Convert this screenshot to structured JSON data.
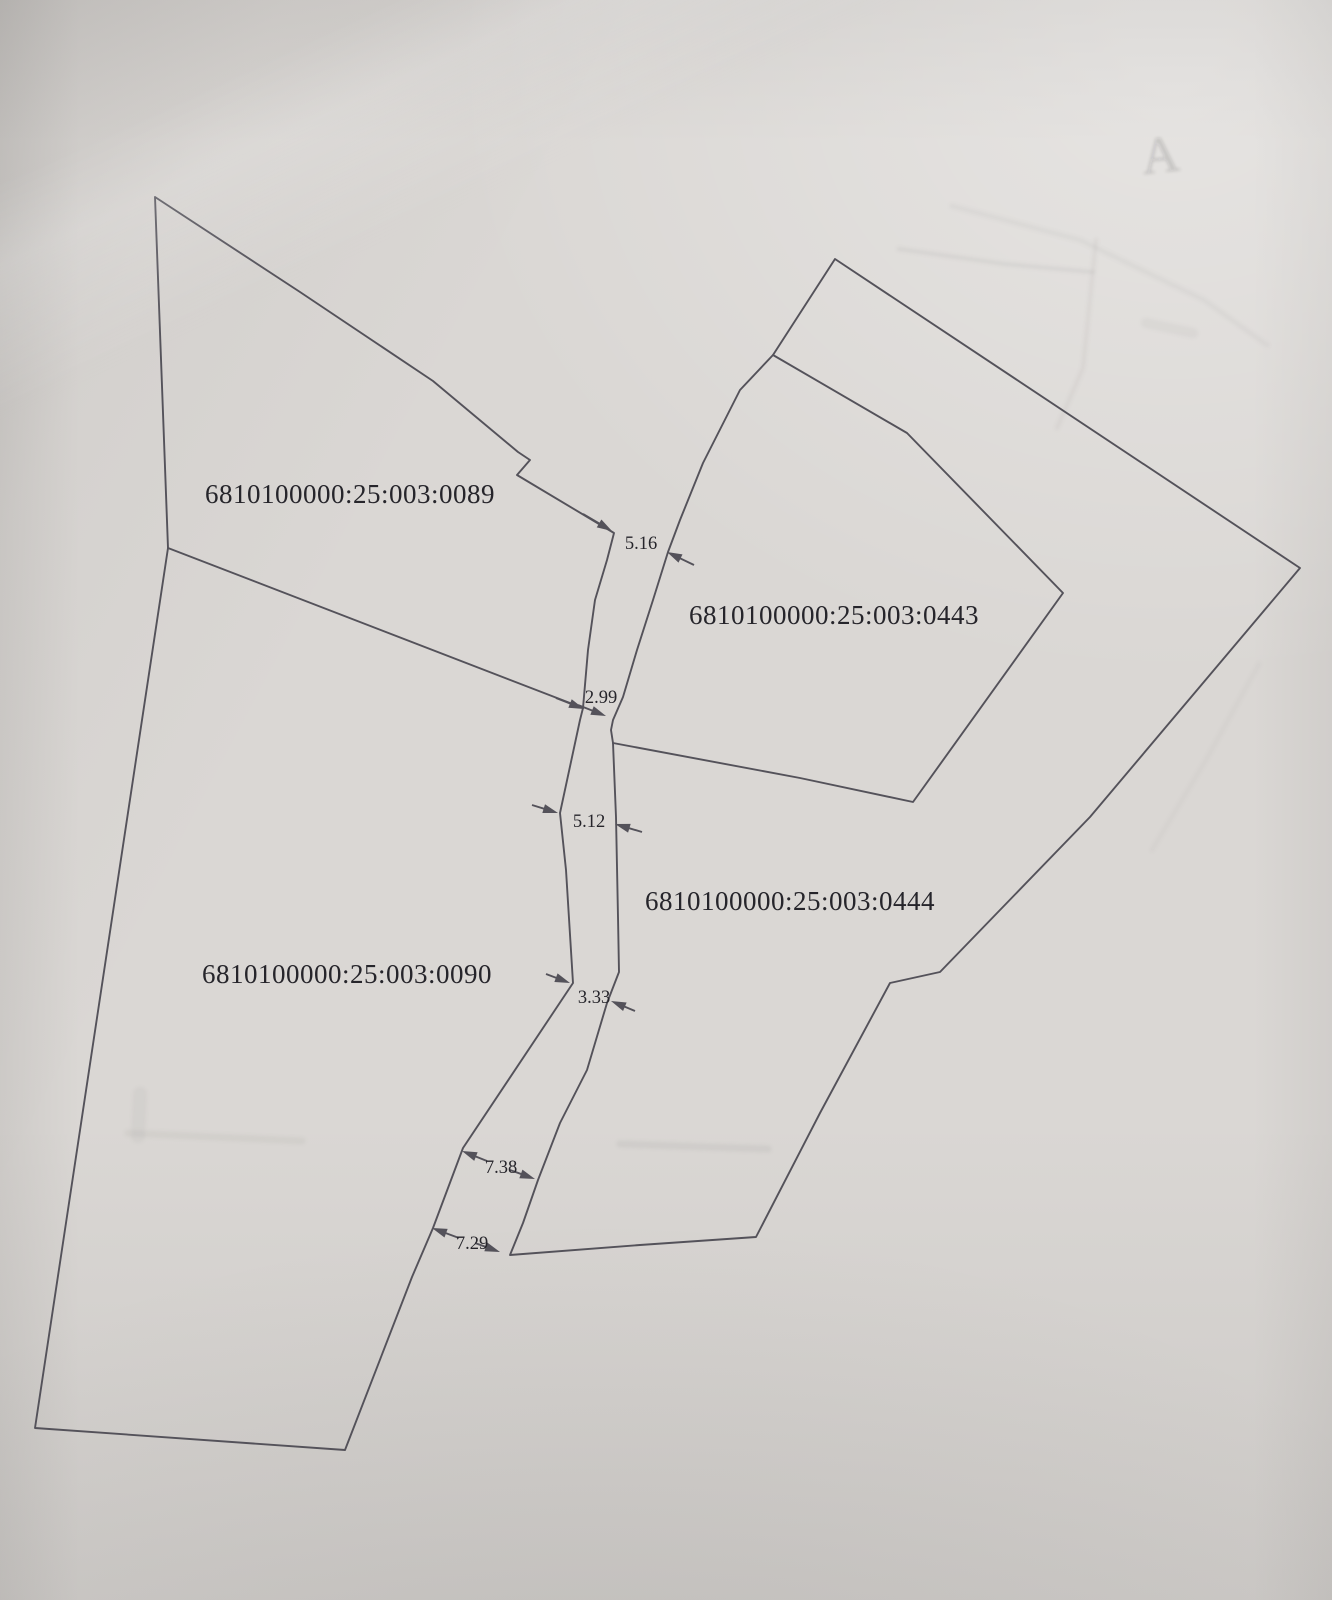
{
  "photo": {
    "description_colors": {
      "paper": "#dad7d4",
      "boundary_line": "#54525a",
      "text": "#26252b",
      "ghost": "#98958f"
    }
  },
  "map": {
    "width": 1332,
    "height": 1600,
    "line_color": "#54525a",
    "line_width": 1.9,
    "label_color": "#23222a",
    "label_font_size": 27,
    "dim_font_size": 18.5,
    "boundaries": [
      {
        "name": "left-block-outline",
        "closed": true,
        "points": [
          [
            155,
            197
          ],
          [
            300,
            292
          ],
          [
            433,
            381
          ],
          [
            518,
            452
          ],
          [
            530,
            460
          ],
          [
            517,
            475
          ],
          [
            614,
            533
          ],
          [
            607,
            560
          ],
          [
            595,
            600
          ],
          [
            588,
            650
          ],
          [
            583,
            708
          ],
          [
            580,
            720
          ],
          [
            560,
            813
          ],
          [
            566,
            870
          ],
          [
            573,
            983
          ],
          [
            463,
            1148
          ],
          [
            433,
            1228
          ],
          [
            412,
            1277
          ],
          [
            345,
            1450
          ],
          [
            35,
            1428
          ],
          [
            168,
            548
          ]
        ]
      },
      {
        "name": "boundary-0089-0090",
        "closed": false,
        "points": [
          [
            168,
            548
          ],
          [
            583,
            708
          ]
        ]
      },
      {
        "name": "right-block-outline",
        "closed": true,
        "points": [
          [
            835,
            259
          ],
          [
            1300,
            568
          ],
          [
            1090,
            817
          ],
          [
            940,
            972
          ],
          [
            890,
            983
          ],
          [
            820,
            1113
          ],
          [
            756,
            1237
          ],
          [
            640,
            1245
          ],
          [
            510,
            1255
          ],
          [
            523,
            1223
          ],
          [
            538,
            1180
          ],
          [
            560,
            1123
          ],
          [
            587,
            1070
          ],
          [
            607,
            1003
          ],
          [
            619,
            972
          ],
          [
            618,
            917
          ],
          [
            616,
            817
          ],
          [
            613,
            743
          ],
          [
            611,
            730
          ],
          [
            613,
            720
          ],
          [
            623,
            697
          ],
          [
            637,
            650
          ],
          [
            653,
            600
          ],
          [
            668,
            552
          ],
          [
            680,
            520
          ],
          [
            703,
            463
          ],
          [
            740,
            390
          ],
          [
            773,
            355
          ]
        ]
      },
      {
        "name": "boundary-0443-0444",
        "closed": false,
        "points": [
          [
            773,
            355
          ],
          [
            907,
            433
          ],
          [
            1063,
            593
          ],
          [
            913,
            802
          ],
          [
            800,
            778
          ],
          [
            613,
            743
          ]
        ]
      }
    ],
    "parcels": [
      {
        "cadastral_number": "6810100000:25:003:0089",
        "label_x": 350,
        "label_y": 503
      },
      {
        "cadastral_number": "6810100000:25:003:0443",
        "label_x": 834,
        "label_y": 624
      },
      {
        "cadastral_number": "6810100000:25:003:0444",
        "label_x": 790,
        "label_y": 910
      },
      {
        "cadastral_number": "6810100000:25:003:0090",
        "label_x": 347,
        "label_y": 983
      }
    ],
    "dimensions": [
      {
        "value": "5.16",
        "text_x": 641,
        "text_y": 549,
        "arrows": [
          {
            "tail": [
              583,
              514
            ],
            "tip": [
              612,
              531
            ]
          },
          {
            "tail": [
              694,
              565
            ],
            "tip": [
              667,
              552
            ]
          }
        ]
      },
      {
        "value": "2.99",
        "text_x": 601,
        "text_y": 703,
        "arrows": [
          {
            "tail": [
              556,
              698
            ],
            "tip": [
              584,
              709
            ]
          },
          {
            "tail": [
              578,
              705
            ],
            "tip": [
              606,
              716
            ]
          }
        ]
      },
      {
        "value": "5.12",
        "text_x": 589,
        "text_y": 827,
        "arrows": [
          {
            "tail": [
              532,
              805
            ],
            "tip": [
              558,
              813
            ]
          },
          {
            "tail": [
              642,
              832
            ],
            "tip": [
              615,
              824
            ]
          }
        ]
      },
      {
        "value": "3.33",
        "text_x": 594,
        "text_y": 1003,
        "arrows": [
          {
            "tail": [
              546,
              974
            ],
            "tip": [
              570,
              983
            ]
          },
          {
            "tail": [
              635,
              1011
            ],
            "tip": [
              611,
              1001
            ]
          }
        ]
      },
      {
        "value": "7.38",
        "text_x": 501,
        "text_y": 1173,
        "arrows": [
          {
            "tail": [
              487,
              1161
            ],
            "tip": [
              462,
              1151
            ]
          },
          {
            "tail": [
              510,
              1170
            ],
            "tip": [
              535,
              1179
            ]
          }
        ]
      },
      {
        "value": "7.29",
        "text_x": 472,
        "text_y": 1249,
        "arrows": [
          {
            "tail": [
              459,
              1238
            ],
            "tip": [
              432,
              1228
            ]
          },
          {
            "tail": [
              475,
              1243
            ],
            "tip": [
              500,
              1252
            ]
          }
        ]
      }
    ],
    "ghosts": {
      "color": "#8f8c88",
      "items": [
        {
          "type": "text",
          "text": "A",
          "x": 1162,
          "y": 172,
          "size": 52,
          "rotate": -6,
          "opacity": 0.16
        },
        {
          "type": "line",
          "points": [
            [
              899,
              249
            ],
            [
              1005,
              264
            ],
            [
              1093,
              272
            ]
          ],
          "width": 4,
          "opacity": 0.12
        },
        {
          "type": "line",
          "points": [
            [
              1096,
              240
            ],
            [
              1083,
              368
            ],
            [
              1057,
              428
            ]
          ],
          "width": 4,
          "opacity": 0.1
        },
        {
          "type": "line",
          "points": [
            [
              952,
              206
            ],
            [
              1080,
              240
            ],
            [
              1204,
              300
            ],
            [
              1267,
              345
            ]
          ],
          "width": 5,
          "opacity": 0.08
        },
        {
          "type": "line",
          "points": [
            [
              1146,
              323
            ],
            [
              1193,
              333
            ]
          ],
          "width": 10,
          "opacity": 0.08
        },
        {
          "type": "line",
          "points": [
            [
              620,
              1144
            ],
            [
              768,
              1149
            ]
          ],
          "width": 7,
          "opacity": 0.12
        },
        {
          "type": "line",
          "points": [
            [
              128,
              1133
            ],
            [
              302,
              1141
            ]
          ],
          "width": 7,
          "opacity": 0.09
        },
        {
          "type": "line",
          "points": [
            [
              140,
              1094
            ],
            [
              138,
              1136
            ]
          ],
          "width": 14,
          "opacity": 0.08
        },
        {
          "type": "line",
          "points": [
            [
              1259,
              664
            ],
            [
              1206,
              760
            ],
            [
              1152,
              850
            ]
          ],
          "width": 4,
          "opacity": 0.07
        }
      ]
    }
  }
}
